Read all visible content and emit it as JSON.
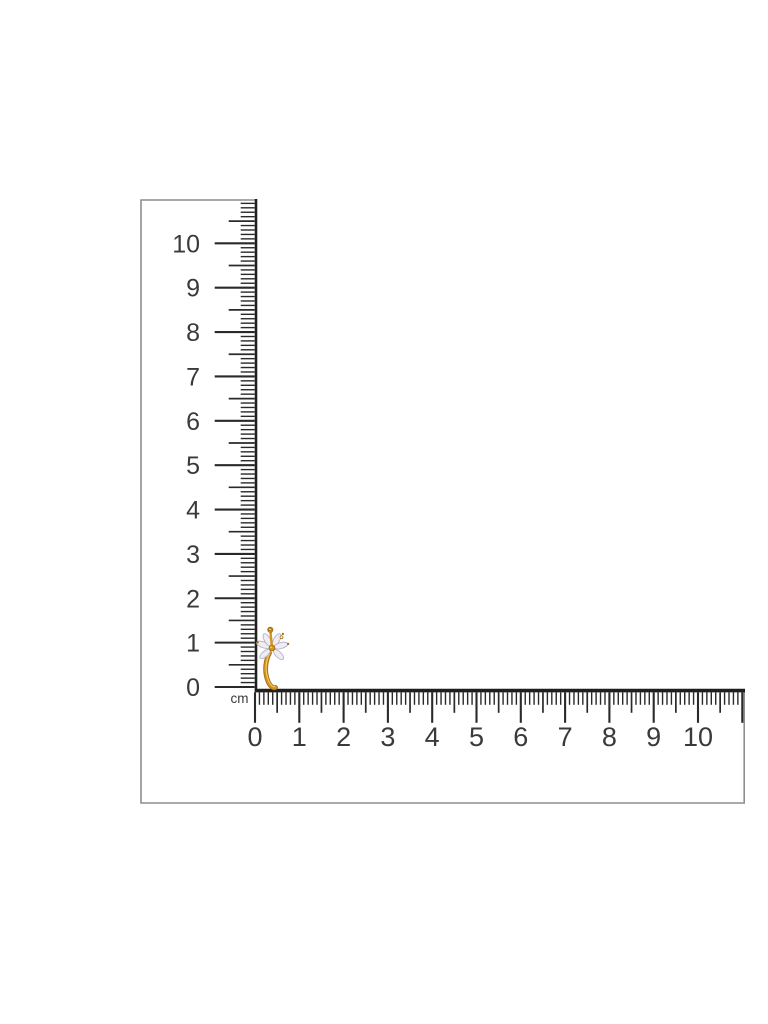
{
  "scene": {
    "background_color": "#ffffff"
  },
  "l_square": {
    "unit_label": "cm",
    "face_color": "#ffffff",
    "outline_color": "#8e8e8e",
    "edge_color": "#1f1f1f",
    "tick_color": "#2a2a2a",
    "label_color": "#3a3a3a",
    "vertical_ruler": {
      "cm_labels": [
        "0",
        "1",
        "2",
        "3",
        "4",
        "5",
        "6",
        "7",
        "8",
        "9",
        "10"
      ],
      "range_cm": [
        0,
        10.9
      ],
      "ticks_per_cm": 10
    },
    "horizontal_ruler": {
      "cm_labels": [
        "0",
        "1",
        "2",
        "3",
        "4",
        "5",
        "6",
        "7",
        "8",
        "9",
        "10"
      ],
      "range_cm": [
        0,
        11
      ],
      "ticks_per_cm": 10
    }
  },
  "item": {
    "gold_color": "#d3941c",
    "gold_dark_color": "#a06c08",
    "gold_light_color": "#f3c567",
    "stone_color": "#efecf4",
    "stone_edge_color": "#b9b1c4"
  }
}
